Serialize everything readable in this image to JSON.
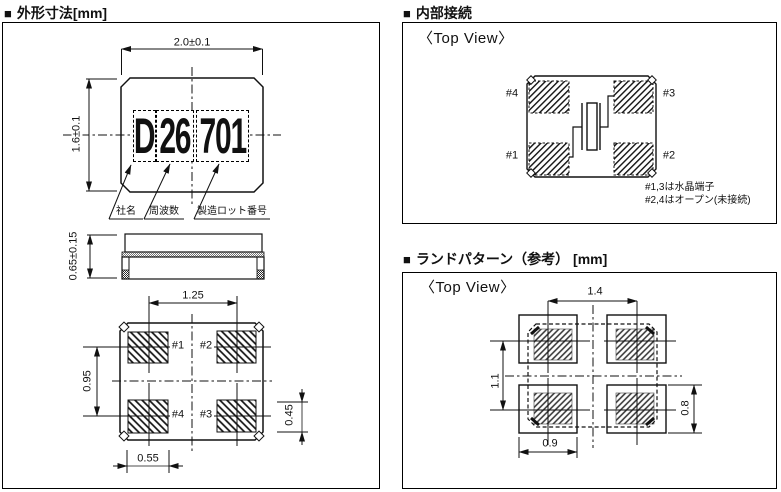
{
  "sections": {
    "outline": {
      "marker": "■",
      "title": "外形寸法[mm]"
    },
    "internal": {
      "marker": "■",
      "title": "内部接続"
    },
    "land": {
      "marker": "■",
      "title": "ランドパターン（参考） [mm]"
    }
  },
  "outline_panel": {
    "top_view": {
      "dim_width": "2.0±0.1",
      "dim_height": "1.6±0.1",
      "marking": {
        "company_code": "D",
        "frequency_code": "26",
        "lot_code": "701"
      },
      "legend": {
        "company": "社名",
        "frequency": "周波数",
        "lot": "製造ロット番号"
      }
    },
    "side_view": {
      "dim_height": "0.65±0.15"
    },
    "bottom_view": {
      "dim_pad_pitch_x": "1.25",
      "dim_pad_pitch_y": "0.95",
      "dim_pad_width": "0.55",
      "dim_pad_height": "0.45",
      "pad_labels": {
        "p1": "#1",
        "p2": "#2",
        "p3": "#3",
        "p4": "#4"
      }
    }
  },
  "internal_panel": {
    "view_label": "〈Top View〉",
    "pad_labels": {
      "p1": "#1",
      "p2": "#2",
      "p3": "#3",
      "p4": "#4"
    },
    "notes": [
      "#1,3は水晶端子",
      "#2,4はオープン(未接続)"
    ]
  },
  "land_panel": {
    "view_label": "〈Top View〉",
    "dim_pad_pitch_x": "1.4",
    "dim_pad_pitch_y": "1.1",
    "dim_pad_width": "0.9",
    "dim_pad_height": "0.8"
  }
}
